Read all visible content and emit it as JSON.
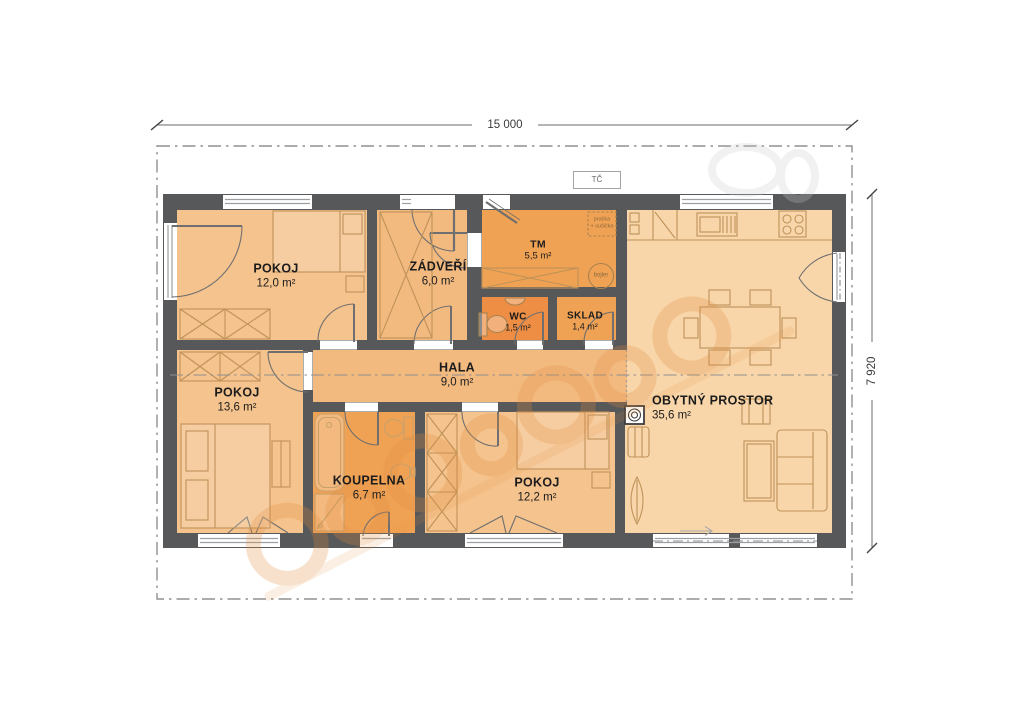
{
  "dimensions": {
    "width_label": "15 000",
    "height_label": "7 920"
  },
  "annotations": {
    "heat_pump_label": "TČ",
    "washer_line1": "pračka",
    "washer_line2": "+ sušička",
    "boiler_label": "bojler"
  },
  "rooms": {
    "pokoj1": {
      "name": "POKOJ",
      "area": "12,0 m²"
    },
    "zadveri": {
      "name": "ZÁDVEŘÍ",
      "area": "6,0 m²"
    },
    "tm": {
      "name": "TM",
      "area": "5,5 m²"
    },
    "wc": {
      "name": "WC",
      "area": "1,5 m²"
    },
    "sklad": {
      "name": "SKLAD",
      "area": "1,4 m²"
    },
    "hala": {
      "name": "HALA",
      "area": "9,0 m²"
    },
    "pokoj2": {
      "name": "POKOJ",
      "area": "13,6 m²"
    },
    "koupelna": {
      "name": "KOUPELNA",
      "area": "6,7 m²"
    },
    "pokoj3": {
      "name": "POKOJ",
      "area": "12,2 m²"
    },
    "obytny": {
      "name": "OBYTNÝ PROSTOR",
      "area": "35,6 m²"
    }
  },
  "colors": {
    "wall": "#57585a",
    "room_light": "#f5c38d",
    "room_medium": "#f3ba80",
    "room_dark": "#f0a254",
    "room_wc": "#ed8e44",
    "room_living": "#f8d6aa",
    "furniture_line": "#bf9259",
    "boundary_line": "#909090"
  }
}
